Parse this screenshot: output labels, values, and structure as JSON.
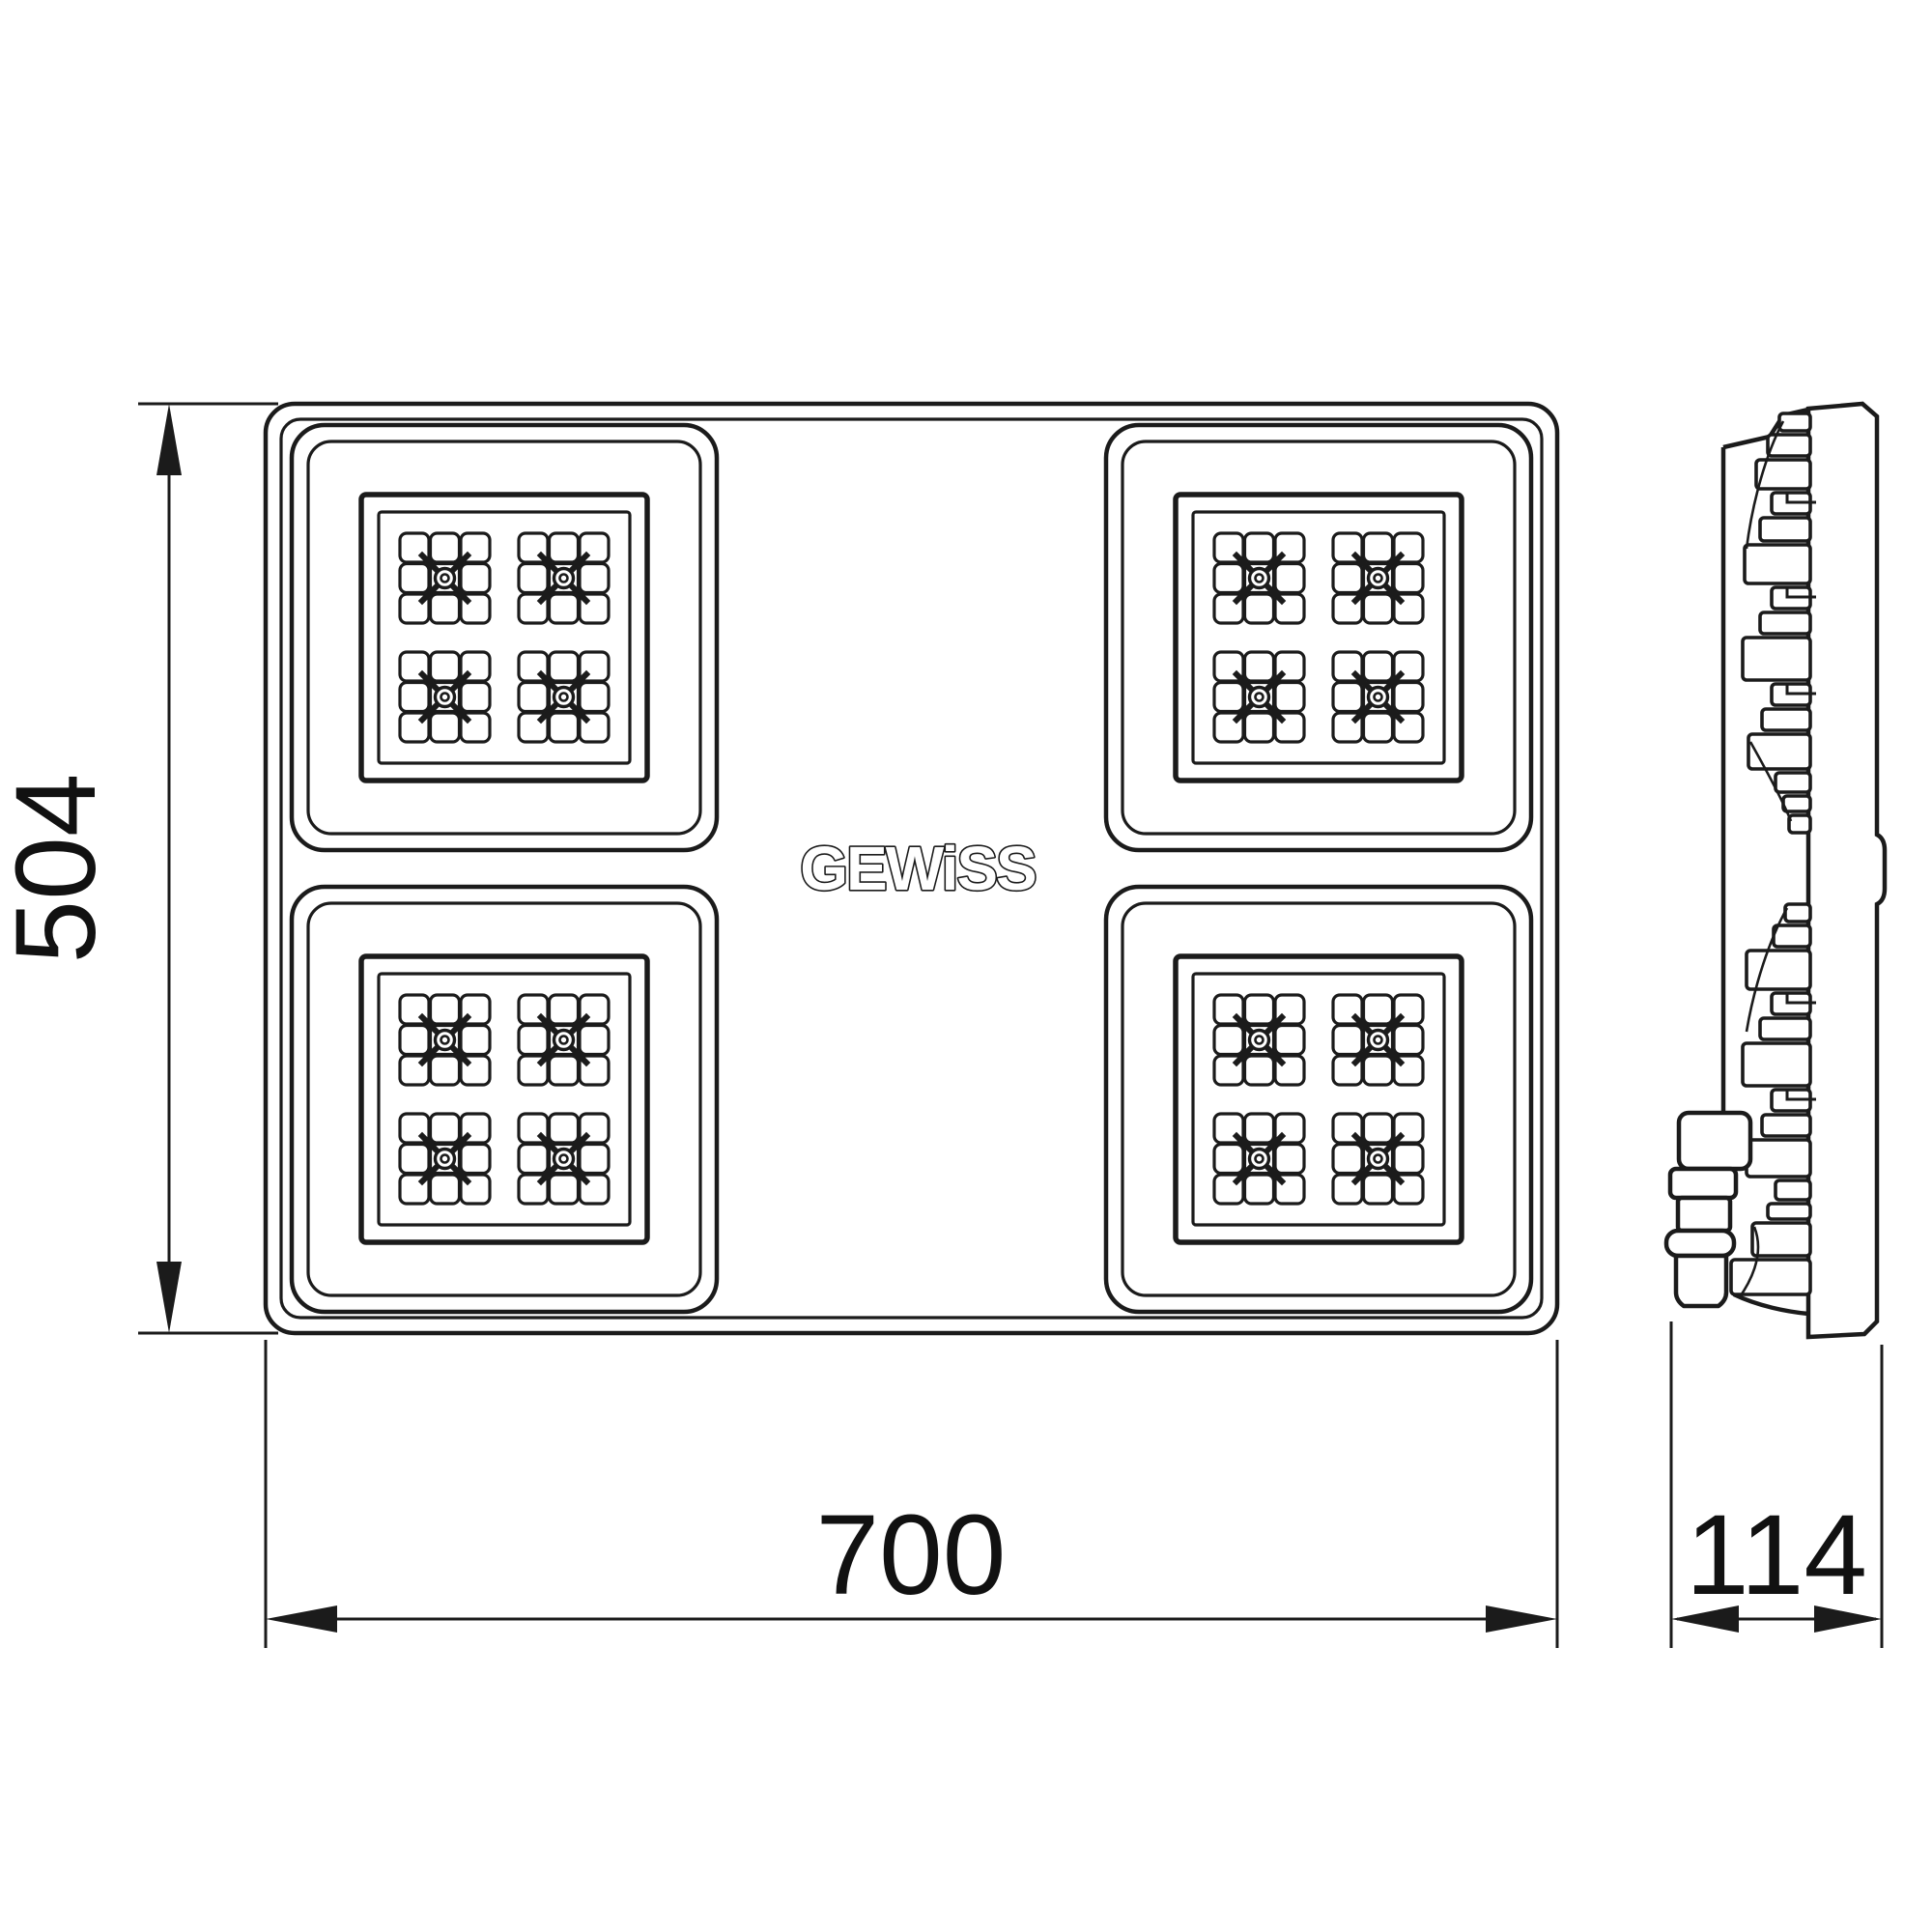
{
  "logo": {
    "text": "GEWiSS"
  },
  "dimensions": {
    "height": "504",
    "width": "700",
    "depth": "114"
  },
  "style": {
    "line_color": "#1b1b1b",
    "background": "#ffffff"
  }
}
